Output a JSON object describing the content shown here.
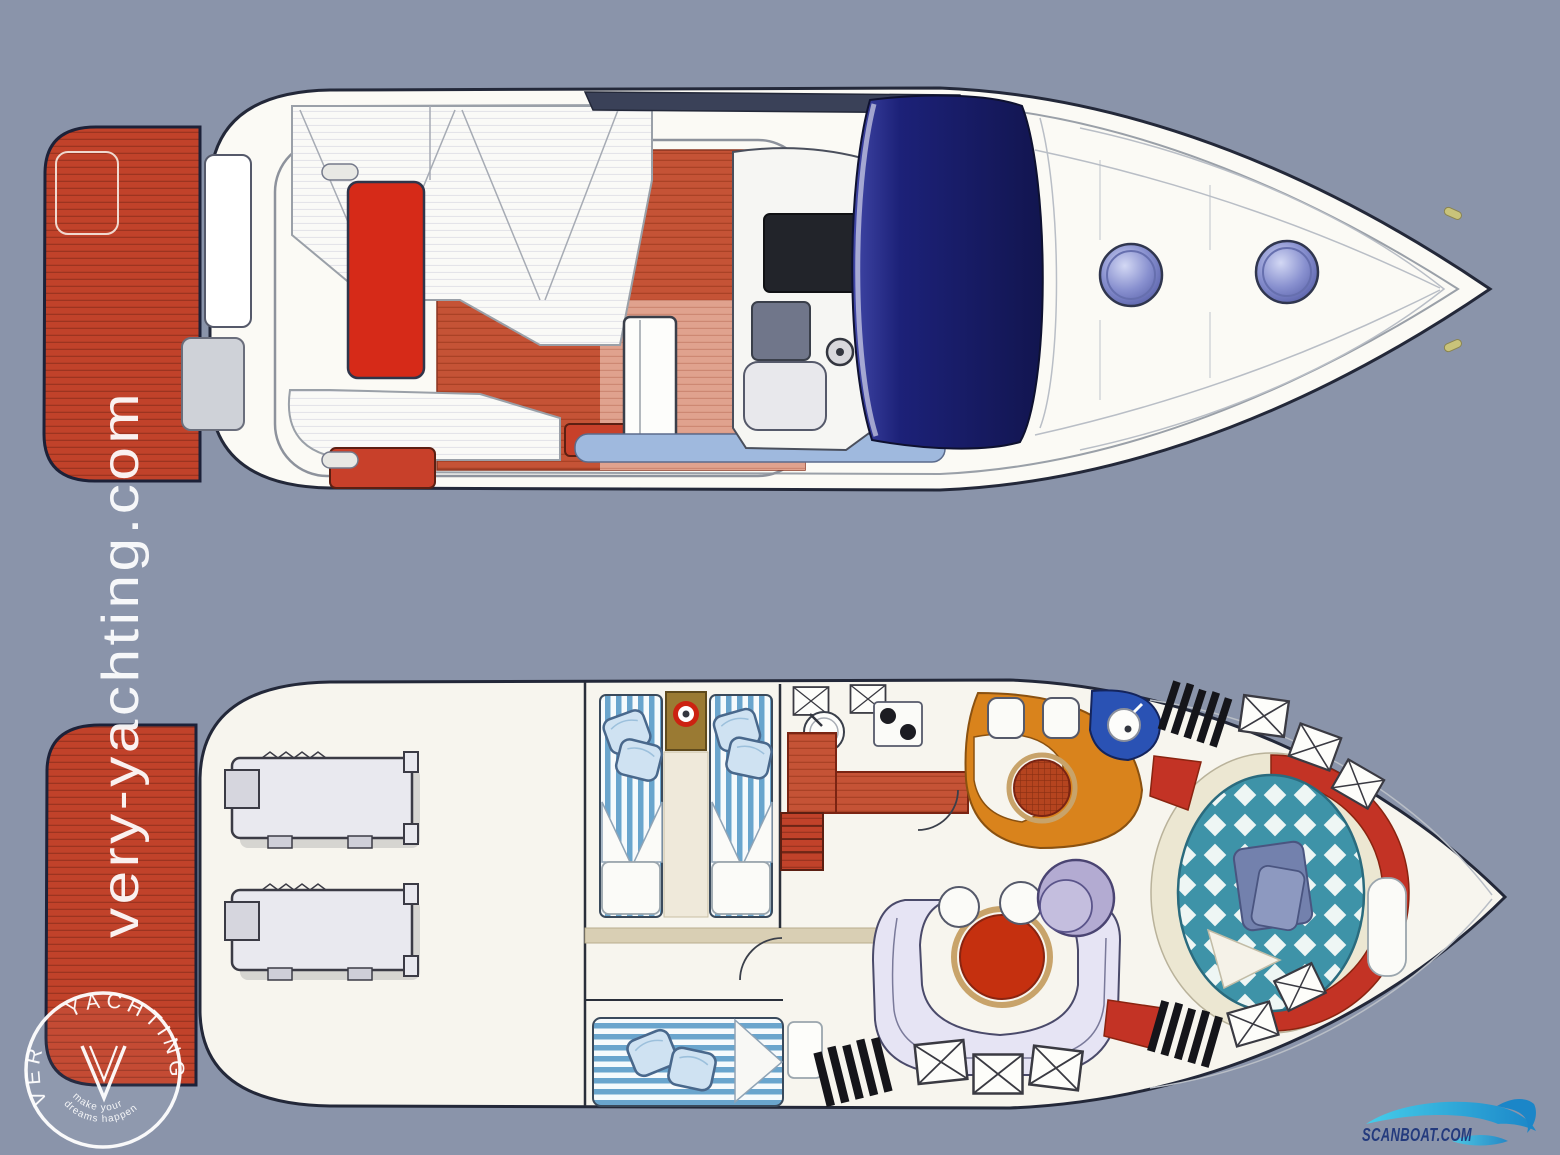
{
  "background": {
    "color": "#8a94aa"
  },
  "watermark": {
    "site_url_vertical": "very-yachting.com",
    "badge": {
      "arc_text_left": "VERY",
      "arc_text_right": "YACHTING",
      "monogram": "V",
      "tagline_line_1": "make your",
      "tagline_line_2": "dreams happen"
    }
  },
  "brand_logo": {
    "text": "SCANBOAT.COM"
  },
  "colors": {
    "background": "#8a94aa",
    "hull_fill": "#fbfaf5",
    "hull_outline": "#232839",
    "deck_red": "#c1422a",
    "cushion_red": "#d62a18",
    "terracotta": "#c55336",
    "salmon": "#e0a28e",
    "walkway_blue": "#9fb9de",
    "windshield_navy": "#191d6e",
    "radar_arch": "#3a4158",
    "porthole_blue": "#8890cf",
    "engine_gray": "#e9e9ef",
    "bed_stripe_blue": "#6aa5cd",
    "pillow_blue": "#cfe2f2",
    "corridor_tan": "#d9cfb4",
    "galley_counter_red": "#c03a20",
    "dinette_orange": "#d9831c",
    "dinette_table_red": "#b5441f",
    "head_royal_blue": "#2a52b4",
    "master_bed_teal": "#3e93a8",
    "carpet_red": "#c33325",
    "sofa_lavender": "#e6e4f4",
    "chair_lavender": "#b3abd2",
    "salon_table_red": "#c5300f",
    "steps_black": "#15151a",
    "scanboat_text": "#233a7d",
    "scanboat_wave": "#35c2e4",
    "watermark_white": "#ffffff"
  }
}
